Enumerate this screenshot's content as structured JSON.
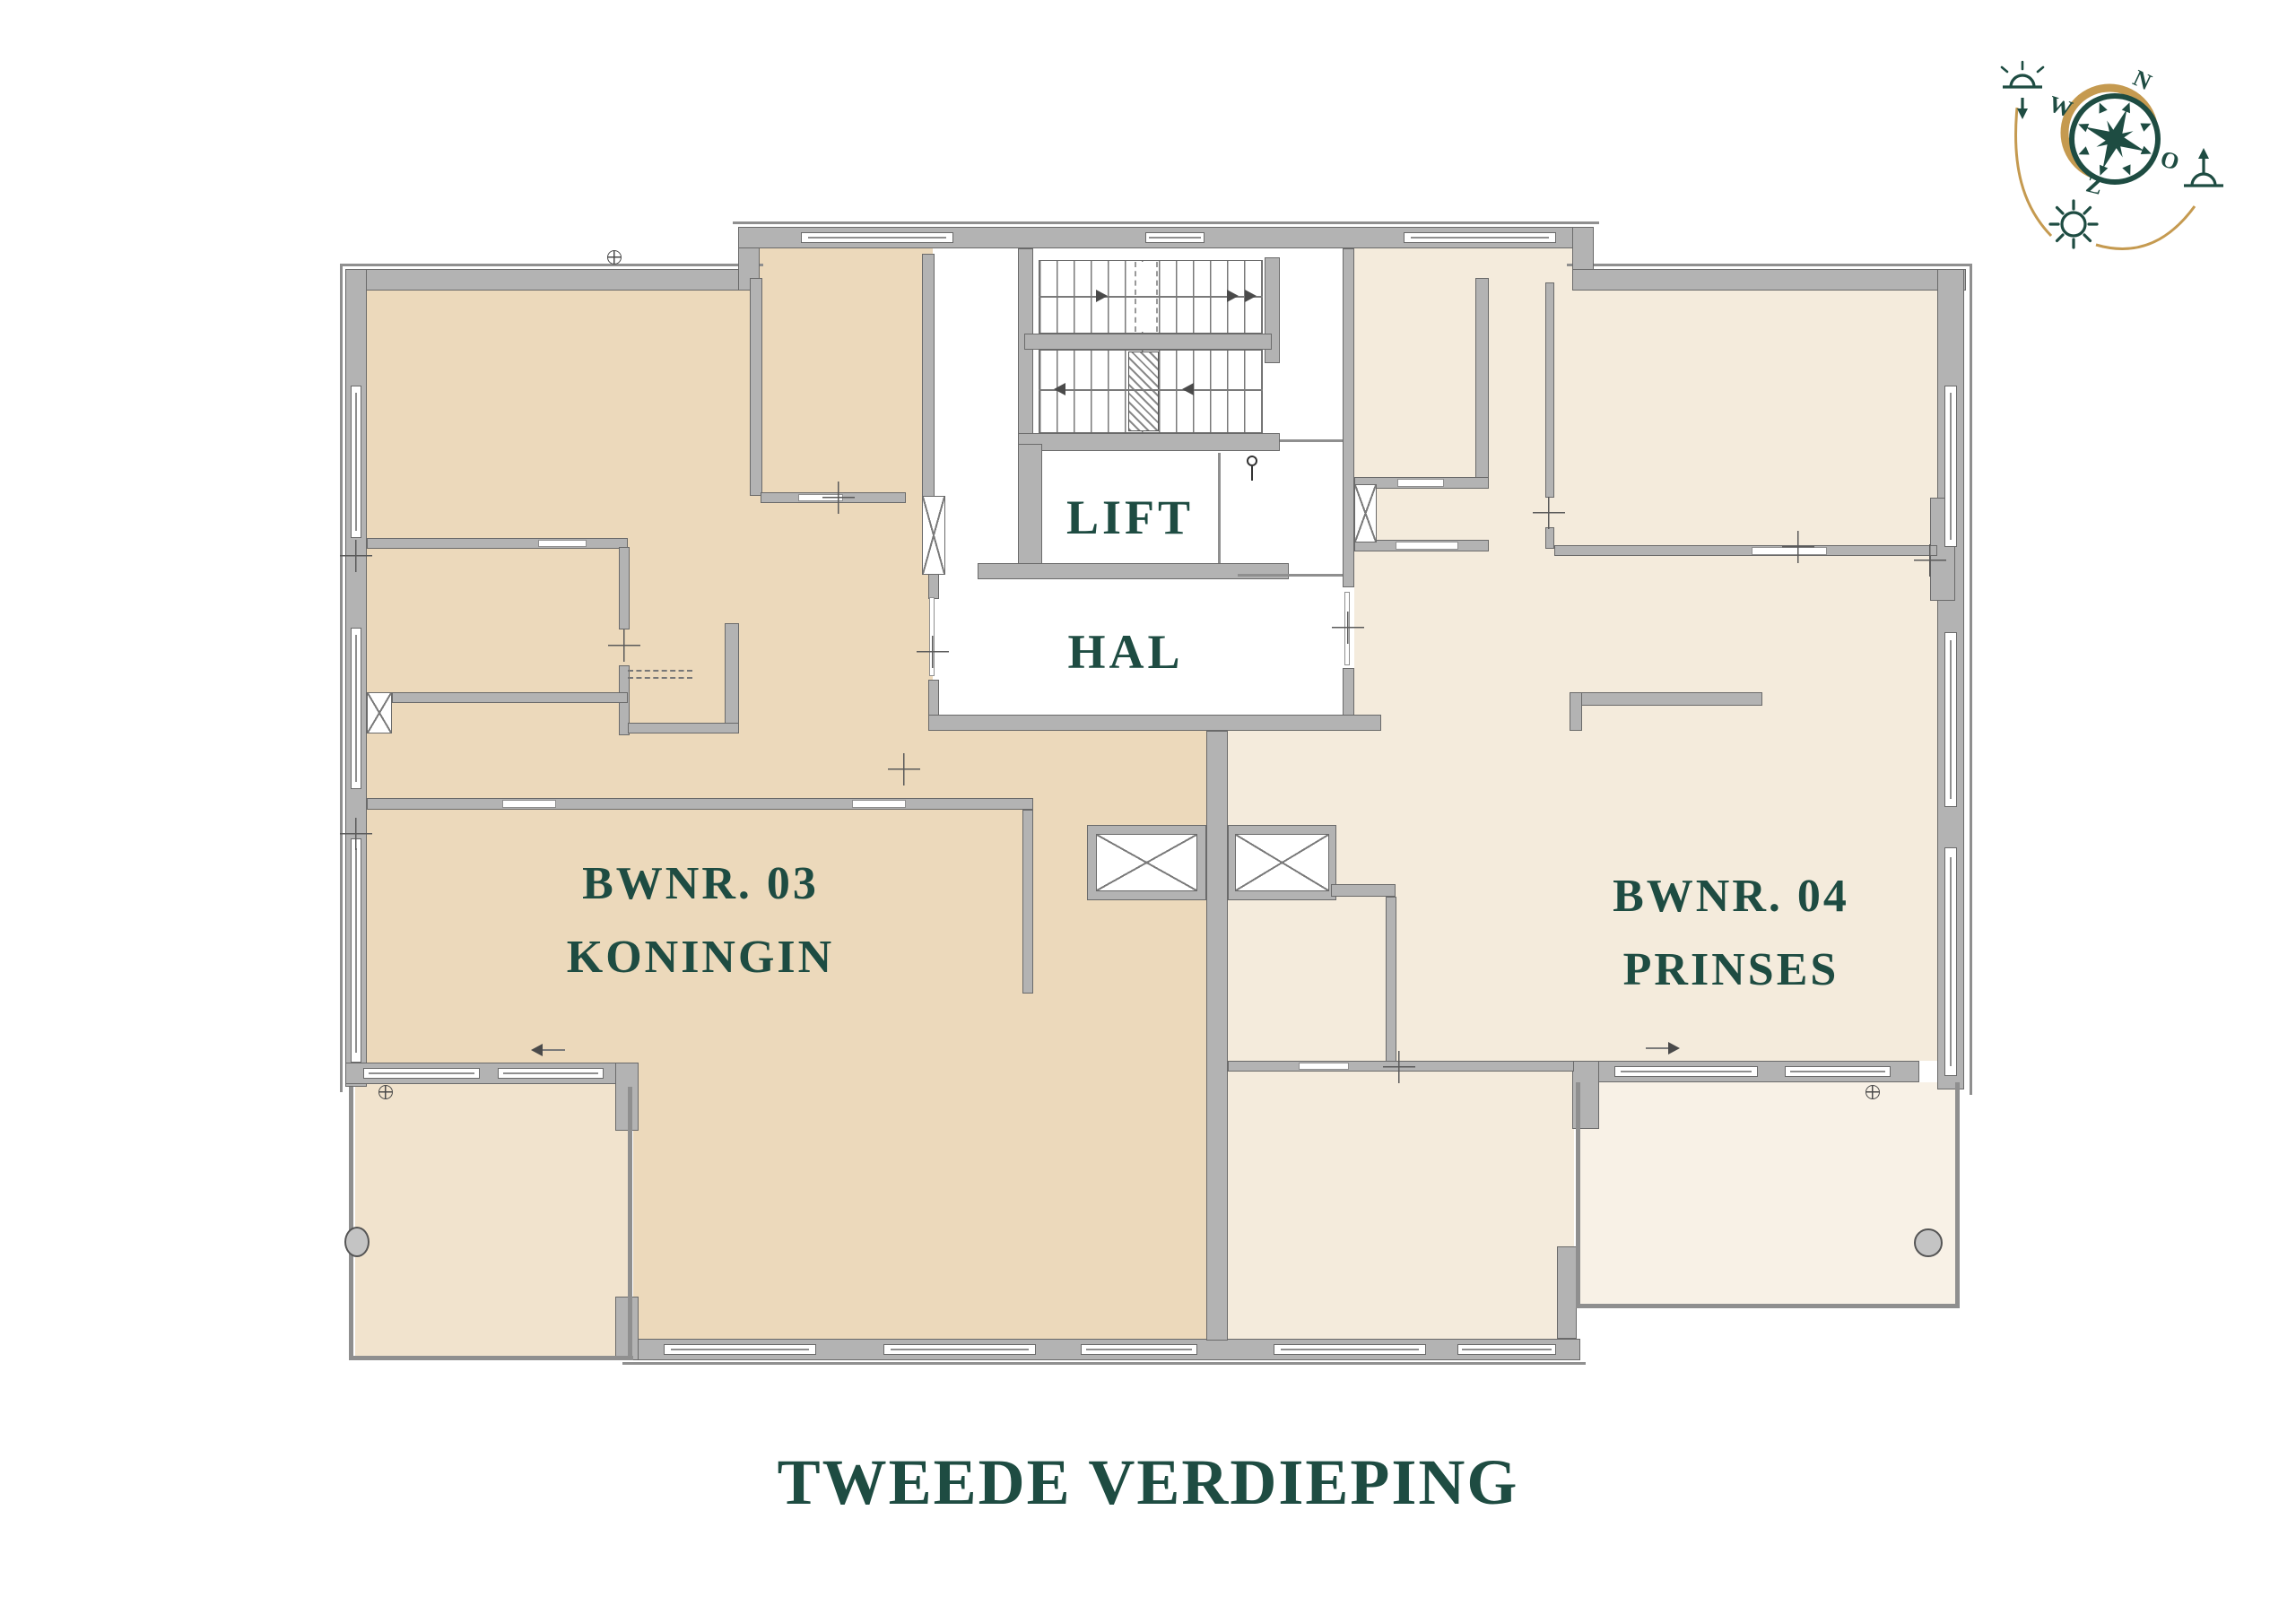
{
  "title": "TWEEDE VERDIEPING",
  "core": {
    "lift": "LIFT",
    "hal": "HAL"
  },
  "apartments": [
    {
      "number": "BWNR. 03",
      "name": "KONINGIN"
    },
    {
      "number": "BWNR. 04",
      "name": "PRINSES"
    }
  ],
  "compass": {
    "north": "N",
    "east": "O",
    "south": "Z",
    "west": "W"
  },
  "colors": {
    "accent_teal": "#1e4c42",
    "compass_gold": "#c59a50",
    "apartment_left_fill": "#ecd9bb",
    "apartment_right_fill": "#f4ebdc",
    "terrace_left_fill": "#f1e3cd",
    "terrace_right_fill": "#f8f1e6",
    "wall_fill": "#b3b3b3",
    "wall_outline": "#6a6a6a"
  }
}
